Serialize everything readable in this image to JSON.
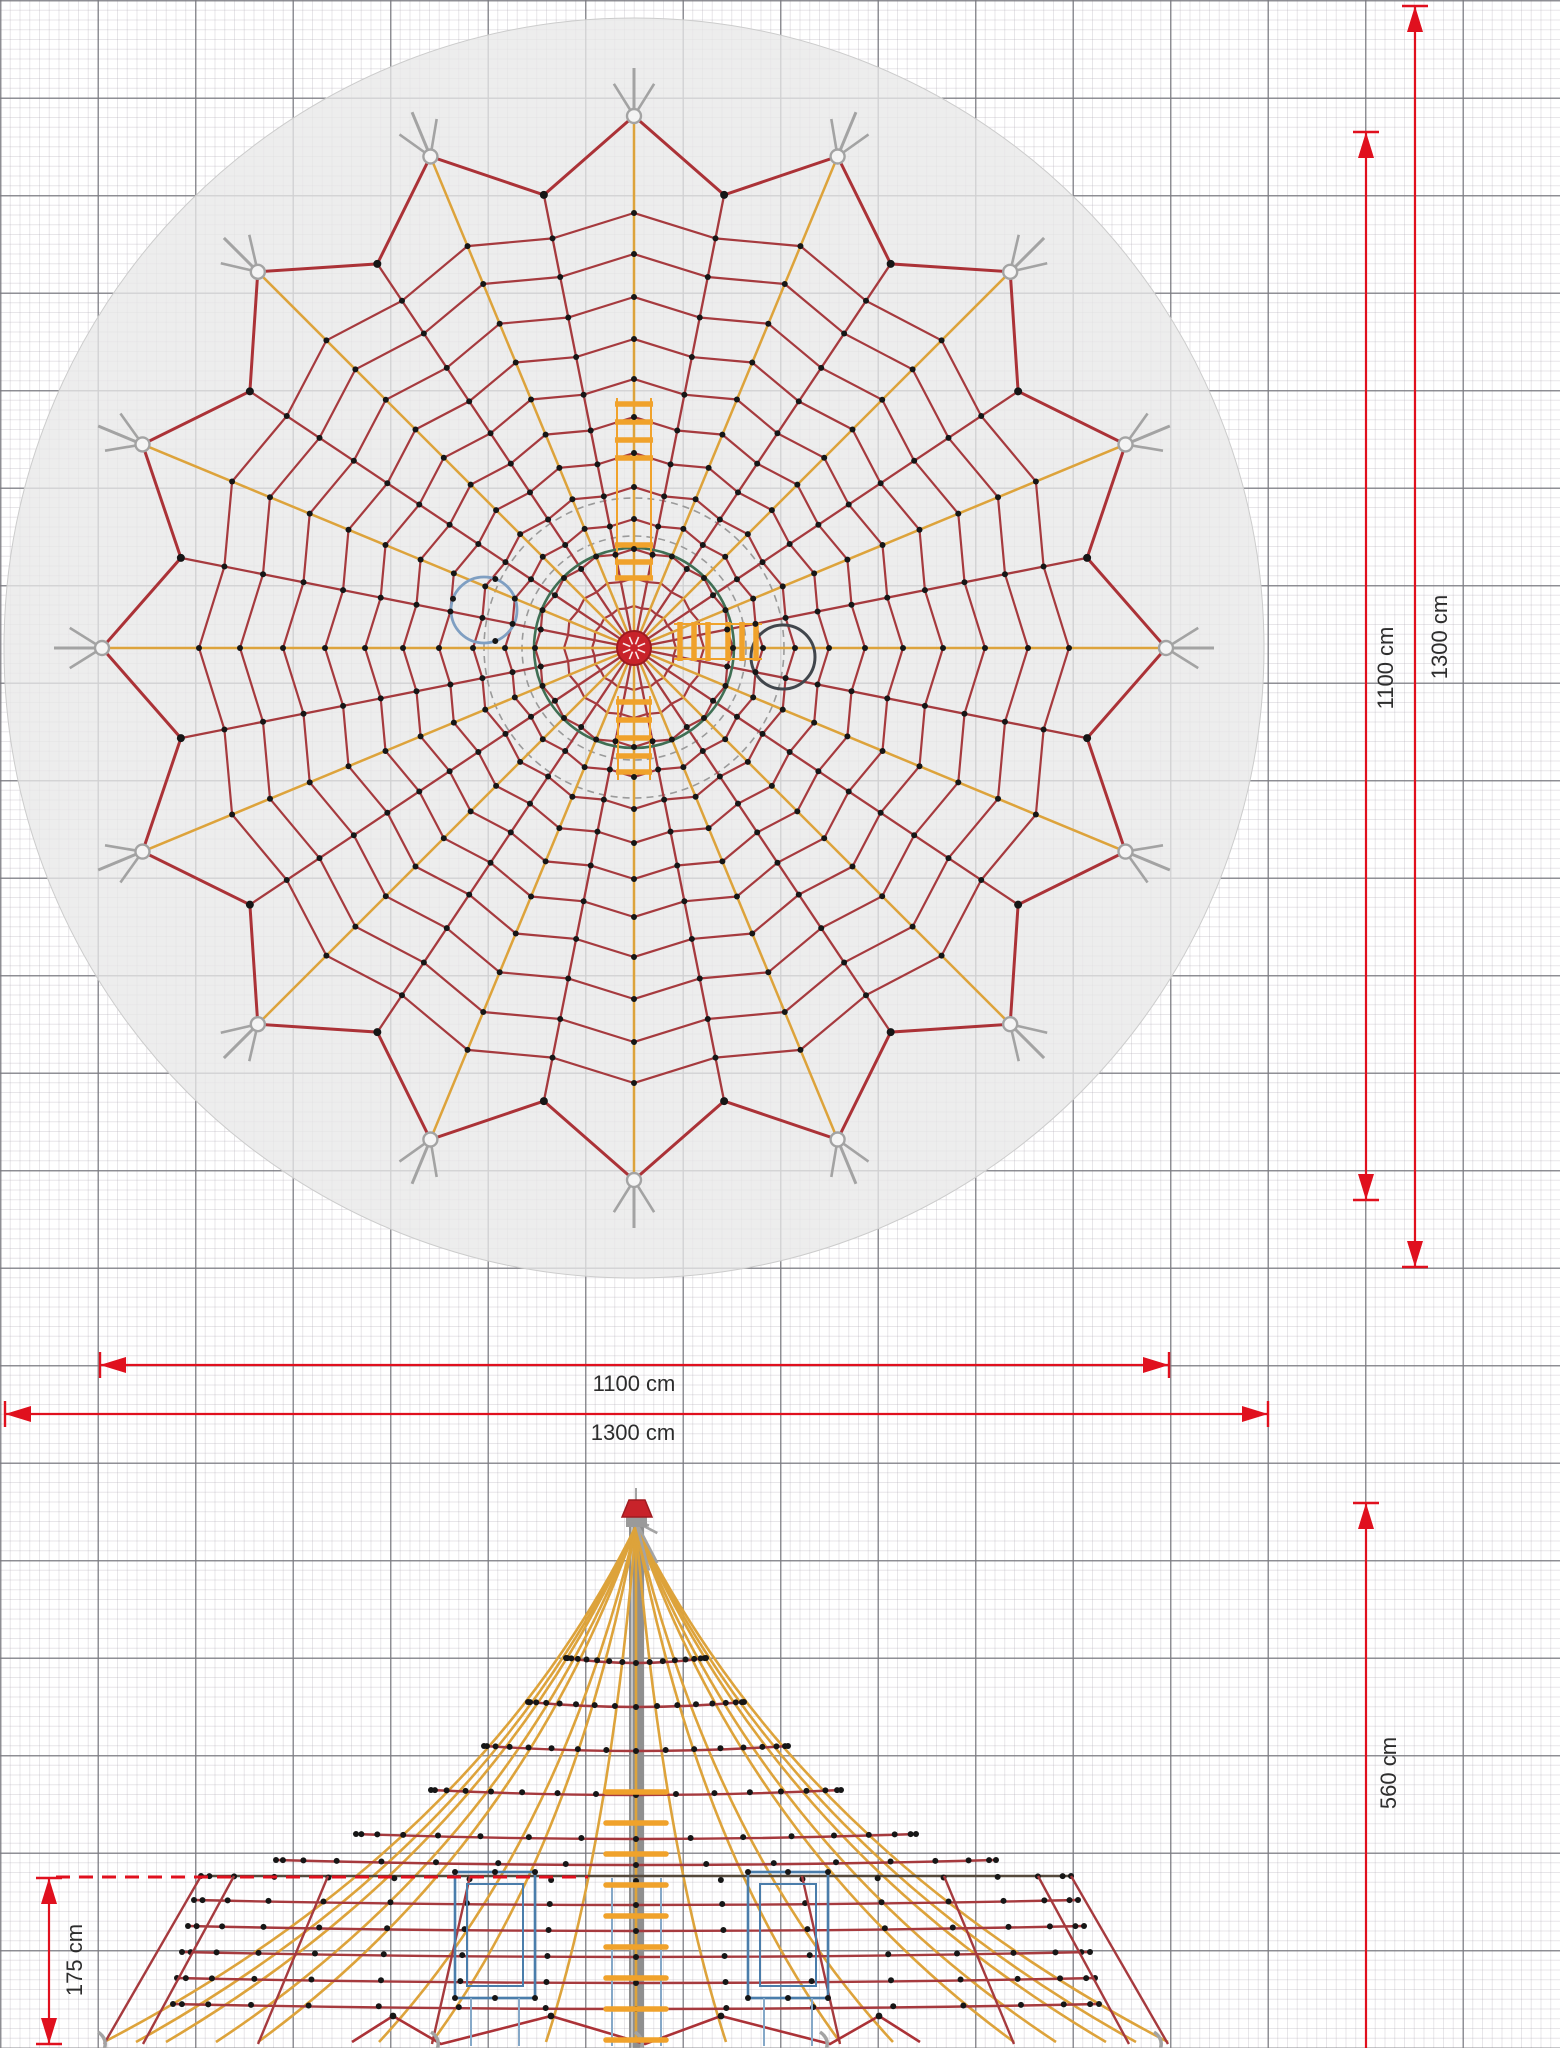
{
  "title": "rope pyramid climbing net - technical drawing (top view and front elevation)",
  "dimensions": [
    {
      "id": "plan-inner-height",
      "label": "1100 cm",
      "orient": "v",
      "pos": 1366,
      "from": 132,
      "to": 1200,
      "a1": true,
      "a2": true,
      "t1": true,
      "t2": true
    },
    {
      "id": "plan-outer-height",
      "label": "1300 cm",
      "orient": "v",
      "pos": 1415,
      "from": 6,
      "to": 1267,
      "a1": true,
      "a2": true,
      "t1": true,
      "t2": true
    },
    {
      "id": "plan-inner-width",
      "label": "1100 cm",
      "orient": "h",
      "pos": 1365,
      "from": 100,
      "to": 1169,
      "a1": true,
      "a2": true,
      "t1": true,
      "t2": true
    },
    {
      "id": "plan-outer-width",
      "label": "1300 cm",
      "orient": "h",
      "pos": 1414,
      "from": 5,
      "to": 1268,
      "a1": true,
      "a2": true,
      "t1": true,
      "t2": true
    },
    {
      "id": "elevation-height",
      "label": "560 cm",
      "orient": "v",
      "pos": 1366,
      "from": 1503,
      "to": 2048,
      "a1": true,
      "a2": false,
      "t1": true,
      "t2": false
    },
    {
      "id": "elevation-edge-height",
      "label": "175 cm",
      "orient": "v",
      "pos": 49,
      "from": 1878,
      "to": 2044,
      "a1": true,
      "a2": true,
      "t1": true,
      "t2": true
    }
  ],
  "dashed_level_line": {
    "y": 1877,
    "x1": 56,
    "x2": 588
  },
  "colors": {
    "dim_red": "#e0101e",
    "rope_red": "#a63a3e",
    "rope_yellow": "#dda33b",
    "ladder_orange": "#f0a22b",
    "dot_black": "#161616",
    "anchor_gray": "#a3a3a3",
    "disc_gray": "#e8e8e8",
    "green_ring": "#3f6f54",
    "blue_ring": "#7f9fc2",
    "dark_ring": "#41464c",
    "frame_blue": "#4a7dab",
    "mast_gray": "#8f8f8f",
    "cap_red": "#c8232a",
    "label_gray": "#2d2d2d",
    "ring_line_dark": "#55493c"
  },
  "plan": {
    "center": {
      "x": 634,
      "y": 648
    },
    "disc_radius": 630,
    "sectors": 16,
    "anchor_radius": 532,
    "valley_radius": 462,
    "ring_radii": [
      42,
      70,
      99,
      129,
      161,
      195,
      231,
      269,
      309,
      351,
      394,
      435
    ],
    "ring_dip": 0.96,
    "dashed_circle_radii": [
      112,
      150
    ],
    "green_ring_radius": 100,
    "hub_radius": 17,
    "blue_circle": {
      "cx": 484,
      "cy": 610,
      "r": 33
    },
    "dark_circle": {
      "cx": 783,
      "cy": 657,
      "r": 32
    },
    "ladder_top": {
      "x1": 617,
      "x2": 651,
      "rail_top": 398,
      "rail_bottom": 580,
      "rungs": [
        404,
        422,
        440,
        458,
        545,
        562,
        578
      ]
    },
    "ladder_right": {
      "y1": 622,
      "y2": 661,
      "rails": [
        624,
        659
      ],
      "rungs_x": [
        680,
        694,
        708,
        728,
        742,
        756
      ]
    },
    "ladder_bottom": {
      "x1": 618,
      "x2": 650,
      "rail_top": 696,
      "rail_bottom": 780,
      "rungs": [
        702,
        720,
        738,
        756,
        772
      ]
    }
  },
  "elevation": {
    "cx": 636,
    "apex_y": 1526,
    "cap": {
      "x1": 622,
      "x2": 652,
      "top_x1": 629,
      "top_x2": 645,
      "y_top": 1500,
      "y_bottom": 1517
    },
    "mast": {
      "x": 629,
      "w": 15,
      "top": 1517,
      "bottom": 2048
    },
    "rope_offsets": [
      0,
      90,
      204,
      257,
      378,
      420,
      470,
      500,
      532
    ],
    "rope_levels": [
      {
        "y": 1658,
        "hw": 70
      },
      {
        "y": 1702,
        "hw": 108
      },
      {
        "y": 1746,
        "hw": 152
      },
      {
        "y": 1790,
        "hw": 205
      },
      {
        "y": 1834,
        "hw": 280
      },
      {
        "y": 1860,
        "hw": 360
      },
      {
        "y": 1900,
        "hw": 442
      },
      {
        "y": 1926,
        "hw": 448
      },
      {
        "y": 1952,
        "hw": 454
      },
      {
        "y": 1978,
        "hw": 459
      },
      {
        "y": 2004,
        "hw": 463
      }
    ],
    "ring_level": {
      "y": 1876,
      "hw": 435
    },
    "skirt_diagonals": [
      [
        166,
        204
      ],
      [
        308,
        378
      ],
      [
        402,
        493
      ]
    ],
    "edge_lines": [
      [
        435,
        532
      ]
    ],
    "zigzag": [
      [
        393,
        2016
      ],
      [
        441,
        2044
      ],
      [
        551,
        2016
      ],
      [
        645,
        2044
      ],
      [
        721,
        2016
      ],
      [
        830,
        2044
      ],
      [
        879,
        2016
      ]
    ],
    "zigzag_tails": [
      [
        393,
        2016,
        352,
        2042
      ],
      [
        879,
        2016,
        920,
        2042
      ]
    ],
    "hooks_x": [
      441,
      645,
      830,
      108,
      1164
    ],
    "ground_y": 2044,
    "frames": [
      {
        "x": 455,
        "w": 80,
        "y": 1872,
        "h": 126
      },
      {
        "x": 748,
        "w": 80,
        "y": 1872,
        "h": 126
      }
    ],
    "blue_posts": [
      612,
      661
    ],
    "mast_rungs": [
      1792,
      1823,
      1854,
      1885,
      1916,
      1947,
      1978,
      2009,
      2040
    ],
    "rung_halfwidth": 30
  }
}
